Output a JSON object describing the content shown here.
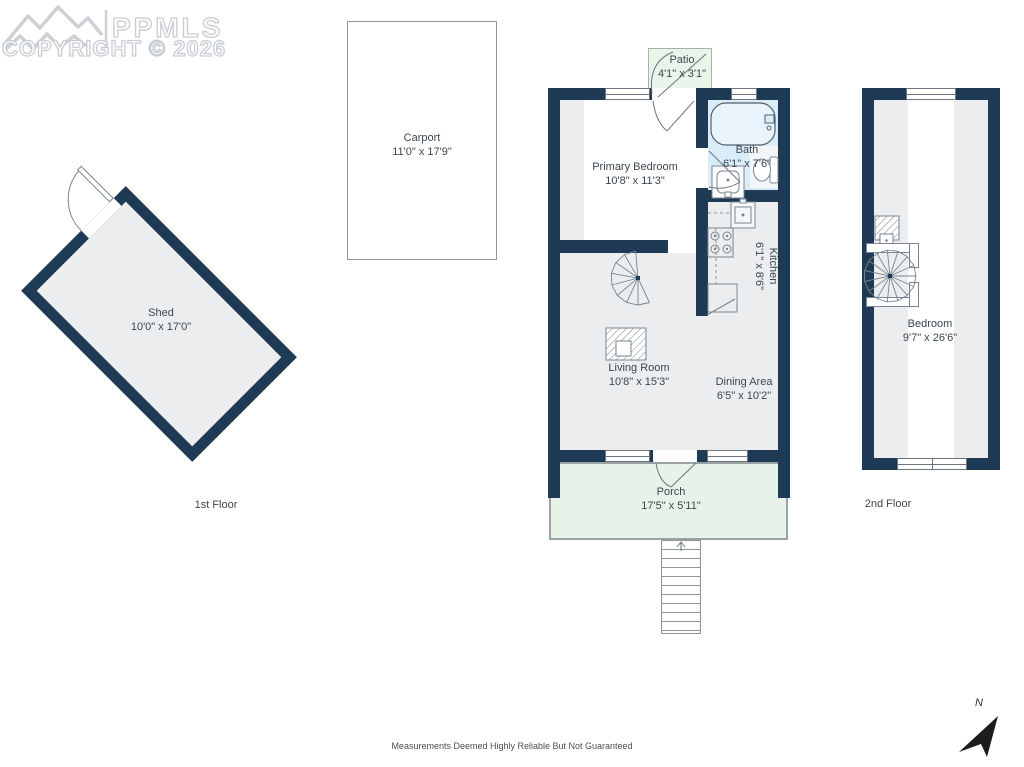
{
  "logo": {
    "mls": "PPMLS",
    "copyright": "COPYRIGHT © 2026"
  },
  "rooms": {
    "shed": {
      "name": "Shed",
      "dims": "10'0\" x 17'0\""
    },
    "carport": {
      "name": "Carport",
      "dims": "11'0\" x 17'9\""
    },
    "patio": {
      "name": "Patio",
      "dims": "4'1\" x 3'1\""
    },
    "primary_bedroom": {
      "name": "Primary Bedroom",
      "dims": "10'8\" x 11'3\""
    },
    "bath": {
      "name": "Bath",
      "dims": "6'1\" x 7'6\""
    },
    "kitchen": {
      "name": "Kitchen",
      "dims": "6'1\" x 8'6\""
    },
    "living_room": {
      "name": "Living Room",
      "dims": "10'8\" x 15'3\""
    },
    "dining_area": {
      "name": "Dining Area",
      "dims": "6'5\" x 10'2\""
    },
    "porch": {
      "name": "Porch",
      "dims": "17'5\" x 5'11\""
    },
    "bedroom_2nd": {
      "name": "Bedroom",
      "dims": "9'7\" x 26'6\""
    }
  },
  "floors": {
    "first": "1st Floor",
    "second": "2nd Floor"
  },
  "compass": {
    "label": "N"
  },
  "disclaimer": "Measurements Deemed Highly Reliable But Not Guaranteed",
  "colors": {
    "wall": "#1e3a54",
    "room_gray": "#ecedef",
    "bath_blue": "#d9ecf8",
    "outdoor_green": "#e7f3e9",
    "thin_border": "#8f969c"
  }
}
